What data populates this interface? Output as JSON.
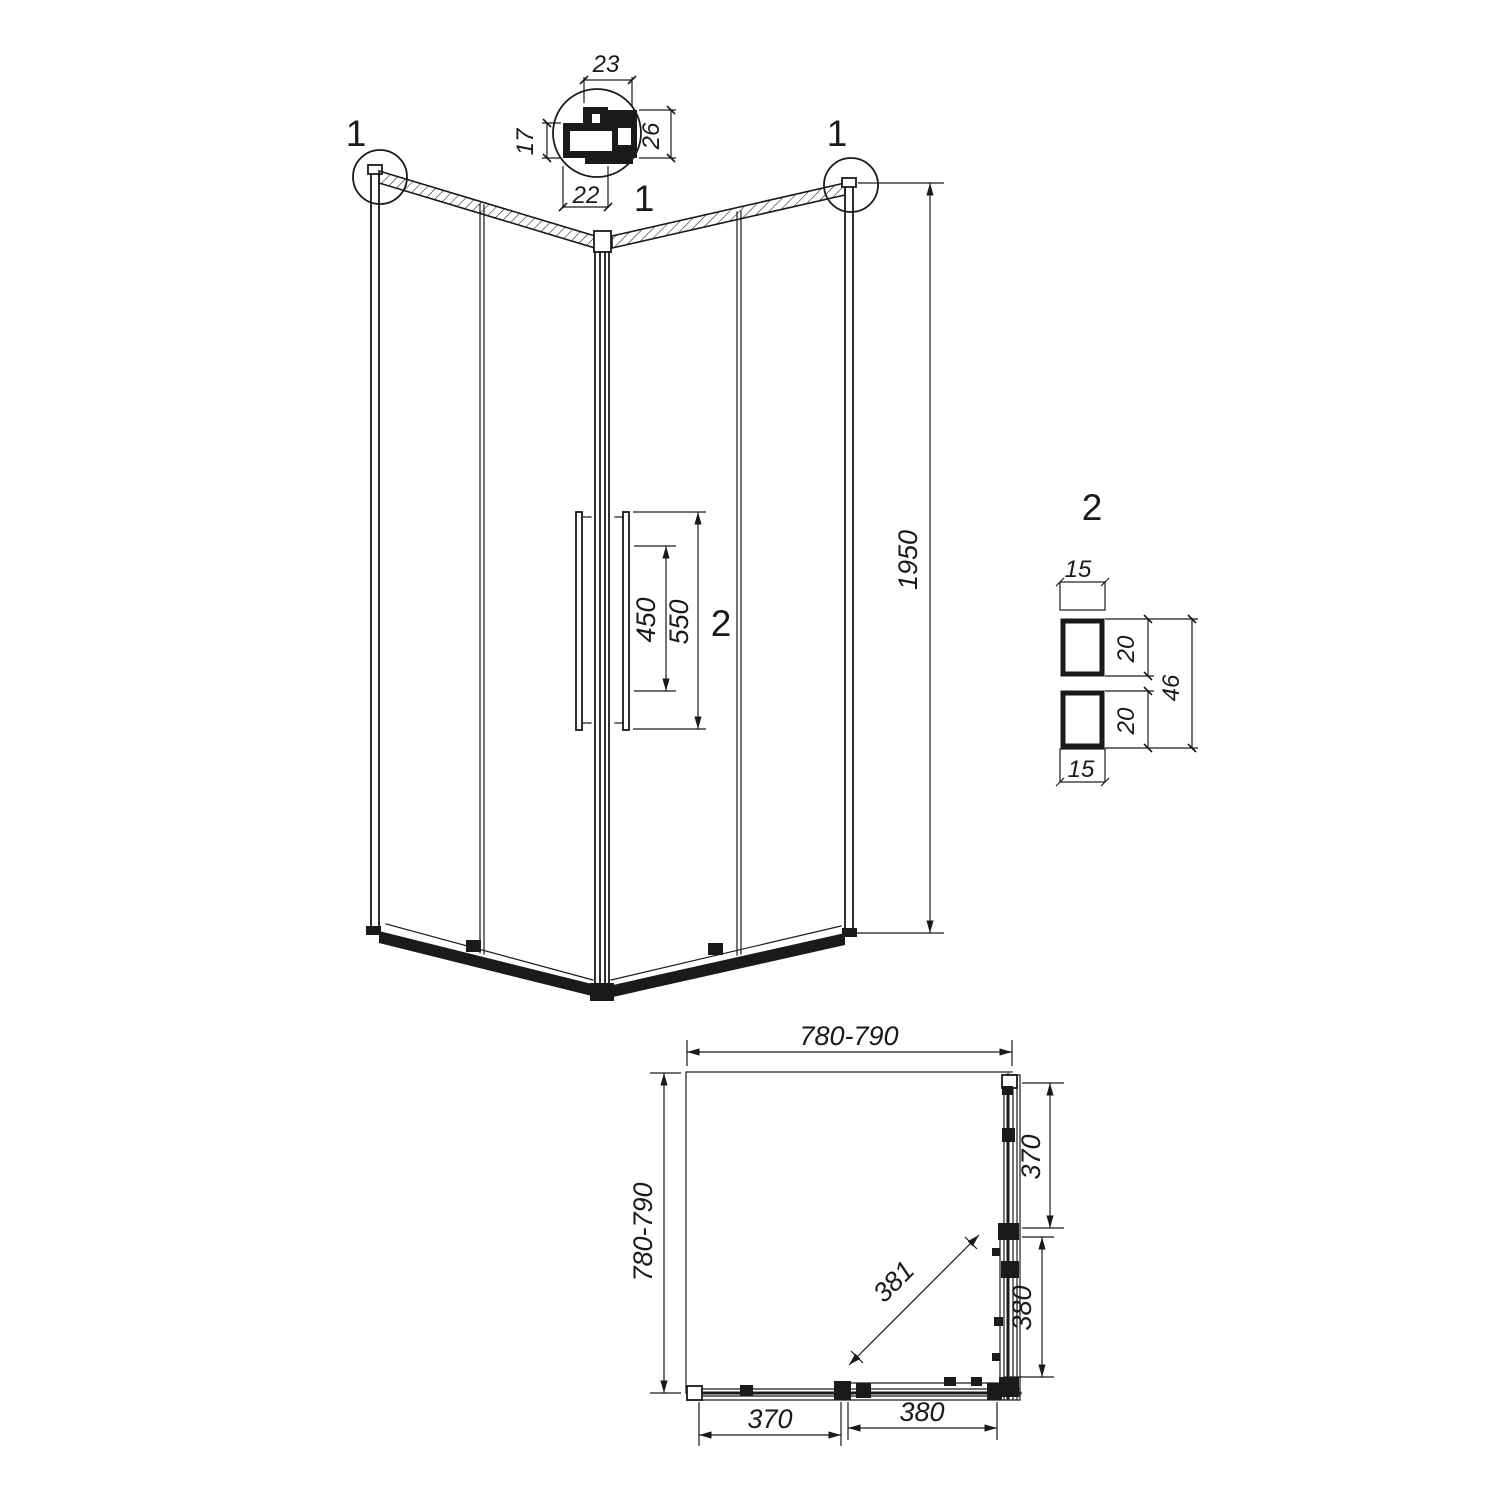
{
  "colors": {
    "line": "#1a1a1a",
    "background": "#ffffff"
  },
  "detail1": {
    "callout": "1",
    "dim_top": "23",
    "dim_left": "17",
    "dim_right": "26",
    "dim_bottom": "22"
  },
  "isometric": {
    "callout_left": "1",
    "callout_right": "1",
    "dim_height": "1950",
    "dim_handle_inner": "450",
    "dim_handle_outer": "550",
    "detail2_ref": "2"
  },
  "detail2": {
    "label": "2",
    "dim_top_width": "15",
    "dim_upper_square": "20",
    "dim_lower_square": "20",
    "dim_overall": "46",
    "dim_bottom_width": "15"
  },
  "plan": {
    "dim_width": "780-790",
    "dim_depth": "780-790",
    "dim_right_fixed": "370",
    "dim_right_door": "380",
    "dim_bottom_fixed": "370",
    "dim_bottom_door": "380",
    "dim_diagonal": "381"
  }
}
